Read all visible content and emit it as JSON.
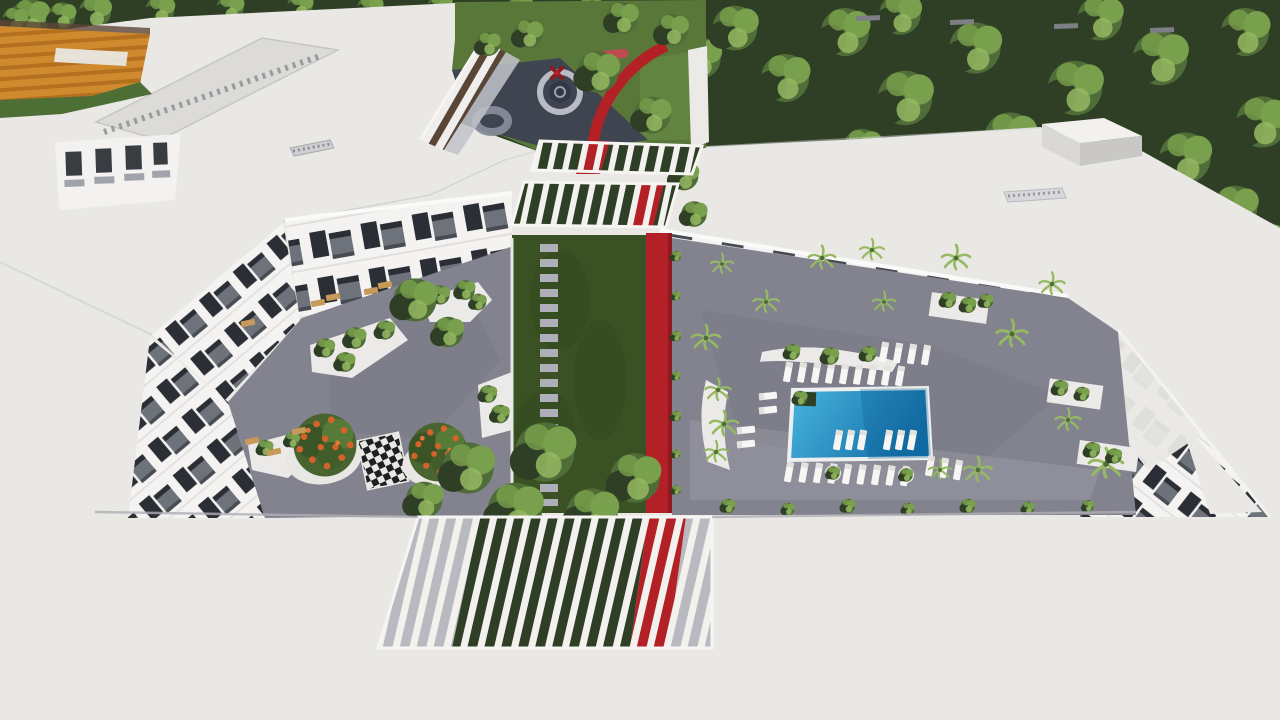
{
  "scene": {
    "title": "Aerial 3D architectural rendering of an apartment complex with two landscaped courtyards, swimming pool, pergolas and a red walking path",
    "type": "architectural-render",
    "visible_features": [
      "white flat roofs",
      "dense green trees",
      "orange sports court",
      "colonnade facade",
      "children playground with circular rings",
      "red sculpture",
      "red walking path spine",
      "central lawn with stepping stones",
      "giant chess board",
      "orange flowering trees",
      "white planters",
      "swimming pool",
      "sun loungers",
      "palm trees",
      "balcony facades",
      "slatted pergolas",
      "roof access box"
    ]
  },
  "palette": {
    "roof_white": "#e9e8e5",
    "roof_shade": "#d8d7d4",
    "tree_dark": "#2e3f25",
    "tree_mid": "#4f6d38",
    "tree_light": "#79a04c",
    "tree_bright": "#95b962",
    "lawn": "#587739",
    "lawn_dark": "#3a5124",
    "pave": "#82838f",
    "pave_dark": "#6f707c",
    "red": "#b32126",
    "red_dark": "#8c1a1e",
    "pool_light": "#4ab6e0",
    "pool_dark": "#1470a8",
    "court_orange": "#cf8a2e",
    "court_stripe": "#b3701f",
    "court_green": "#4d6e35",
    "glass": "#2b2f35",
    "frame": "#6e727b",
    "white": "#f4f3f1",
    "asphalt": "#3e4450",
    "ring": "#b9bcc4",
    "flower": "#d4622a",
    "tan": "#c89a5a"
  },
  "scatter": {
    "canopies_band": [
      [
        30,
        18,
        1.2
      ],
      [
        95,
        12,
        1.0
      ],
      [
        160,
        10,
        0.9
      ],
      [
        230,
        8,
        0.85
      ],
      [
        300,
        6,
        0.8
      ],
      [
        370,
        8,
        0.8
      ],
      [
        440,
        6,
        0.75
      ],
      [
        520,
        8,
        0.8
      ],
      [
        590,
        12,
        0.9
      ],
      [
        645,
        28,
        1.1
      ],
      [
        700,
        58,
        1.3
      ],
      [
        672,
        122,
        1.1
      ],
      [
        688,
        182,
        1.0
      ],
      [
        735,
        28,
        1.4
      ],
      [
        785,
        78,
        1.5
      ],
      [
        845,
        32,
        1.5
      ],
      [
        905,
        98,
        1.7
      ],
      [
        900,
        14,
        1.3
      ],
      [
        975,
        48,
        1.6
      ],
      [
        1010,
        138,
        1.6
      ],
      [
        1075,
        88,
        1.7
      ],
      [
        1100,
        18,
        1.4
      ],
      [
        1160,
        58,
        1.7
      ],
      [
        1185,
        158,
        1.6
      ],
      [
        1245,
        32,
        1.5
      ],
      [
        1262,
        122,
        1.6
      ],
      [
        1235,
        208,
        1.4
      ],
      [
        1130,
        208,
        1.3
      ],
      [
        862,
        148,
        1.2
      ],
      [
        962,
        198,
        1.25
      ],
      [
        1266,
        240,
        1.1
      ],
      [
        15,
        20,
        0.8
      ],
      [
        62,
        16,
        0.85
      ]
    ],
    "canopies_garden": [
      [
        598,
        72,
        1.3
      ],
      [
        652,
        115,
        1.15
      ],
      [
        528,
        34,
        0.9
      ],
      [
        488,
        44,
        0.75
      ],
      [
        622,
        18,
        1.0
      ],
      [
        672,
        30,
        1.0
      ]
    ],
    "canopies_courtyard": [
      [
        468,
        468,
        1.6
      ],
      [
        545,
        452,
        1.85
      ],
      [
        635,
        478,
        1.55
      ],
      [
        515,
        510,
        1.7
      ],
      [
        592,
        514,
        1.6
      ],
      [
        424,
        500,
        1.15
      ],
      [
        684,
        176,
        0.9
      ],
      [
        694,
        214,
        0.8
      ],
      [
        415,
        300,
        1.35
      ],
      [
        448,
        332,
        0.95
      ]
    ],
    "edge_tufts": [
      [
        728,
        506,
        0.45
      ],
      [
        788,
        509,
        0.4
      ],
      [
        848,
        506,
        0.45
      ],
      [
        908,
        509,
        0.4
      ],
      [
        968,
        506,
        0.45
      ],
      [
        1028,
        508,
        0.4
      ],
      [
        1088,
        506,
        0.38
      ]
    ],
    "spine_tufts": [
      [
        676,
        256,
        0.33
      ],
      [
        676,
        296,
        0.28
      ],
      [
        676,
        336,
        0.33
      ],
      [
        676,
        376,
        0.28
      ],
      [
        676,
        416,
        0.33
      ],
      [
        676,
        454,
        0.28
      ],
      [
        676,
        490,
        0.3
      ]
    ],
    "palms": [
      [
        706,
        338,
        1.0
      ],
      [
        766,
        302,
        0.9
      ],
      [
        822,
        258,
        0.95
      ],
      [
        884,
        302,
        0.8
      ],
      [
        956,
        258,
        1.0
      ],
      [
        1012,
        334,
        1.1
      ],
      [
        1106,
        464,
        1.2
      ],
      [
        978,
        470,
        1.0
      ],
      [
        872,
        250,
        0.85
      ],
      [
        722,
        264,
        0.8
      ],
      [
        1052,
        284,
        0.9
      ],
      [
        718,
        390,
        0.9
      ],
      [
        724,
        424,
        1.0
      ],
      [
        716,
        452,
        0.85
      ],
      [
        1068,
        420,
        0.9
      ],
      [
        940,
        470,
        0.8
      ]
    ],
    "planter_bushes": [
      [
        325,
        348,
        0.6
      ],
      [
        355,
        338,
        0.68
      ],
      [
        385,
        330,
        0.6
      ],
      [
        345,
        362,
        0.62
      ],
      [
        440,
        295,
        0.6
      ],
      [
        465,
        290,
        0.62
      ],
      [
        478,
        302,
        0.52
      ],
      [
        488,
        394,
        0.55
      ],
      [
        500,
        414,
        0.58
      ],
      [
        265,
        448,
        0.5
      ],
      [
        292,
        440,
        0.48
      ],
      [
        948,
        300,
        0.5
      ],
      [
        968,
        305,
        0.5
      ],
      [
        986,
        301,
        0.45
      ],
      [
        1060,
        388,
        0.5
      ],
      [
        1082,
        394,
        0.45
      ],
      [
        1092,
        450,
        0.5
      ],
      [
        1114,
        456,
        0.48
      ],
      [
        792,
        352,
        0.5
      ],
      [
        830,
        356,
        0.55
      ],
      [
        868,
        354,
        0.5
      ],
      [
        833,
        473,
        0.42
      ],
      [
        906,
        475,
        0.42
      ],
      [
        800,
        398,
        0.45
      ]
    ]
  },
  "lounger_rows": [
    {
      "sym": "lounger-v",
      "x": 788,
      "y": 372,
      "n": 9,
      "dx": 14,
      "dy": 0.5,
      "rot": 10
    },
    {
      "sym": "lounger-v",
      "x": 789,
      "y": 472,
      "n": 9,
      "dx": 14.5,
      "dy": 0.5,
      "rot": 10
    },
    {
      "sym": "lounger-v",
      "x": 838,
      "y": 440,
      "n": 3,
      "dx": 12,
      "dy": 0,
      "rot": 10
    },
    {
      "sym": "lounger-v",
      "x": 888,
      "y": 440,
      "n": 3,
      "dx": 12,
      "dy": 0,
      "rot": 10
    },
    {
      "sym": "lounger-h",
      "x": 768,
      "y": 396,
      "n": 2,
      "dx": 0,
      "dy": 14,
      "rot": -6
    },
    {
      "sym": "lounger-h",
      "x": 746,
      "y": 430,
      "n": 2,
      "dx": 0,
      "dy": 14,
      "rot": -6
    },
    {
      "sym": "lounger-v",
      "x": 930,
      "y": 466,
      "n": 3,
      "dx": 14,
      "dy": 2,
      "rot": 10
    },
    {
      "sym": "lounger-v",
      "x": 884,
      "y": 352,
      "n": 4,
      "dx": 14,
      "dy": 1,
      "rot": 10
    }
  ],
  "patio_chairs": [
    [
      318,
      303,
      -10
    ],
    [
      333,
      297,
      -10
    ],
    [
      371,
      291,
      -10
    ],
    [
      385,
      285,
      -10
    ],
    [
      252,
      441,
      -12
    ],
    [
      274,
      452,
      -12
    ],
    [
      299,
      431,
      -12
    ],
    [
      248,
      323,
      -12
    ]
  ],
  "roof_ticks": [
    [
      856,
      16
    ],
    [
      950,
      20
    ],
    [
      1054,
      24
    ],
    [
      1150,
      28
    ]
  ]
}
